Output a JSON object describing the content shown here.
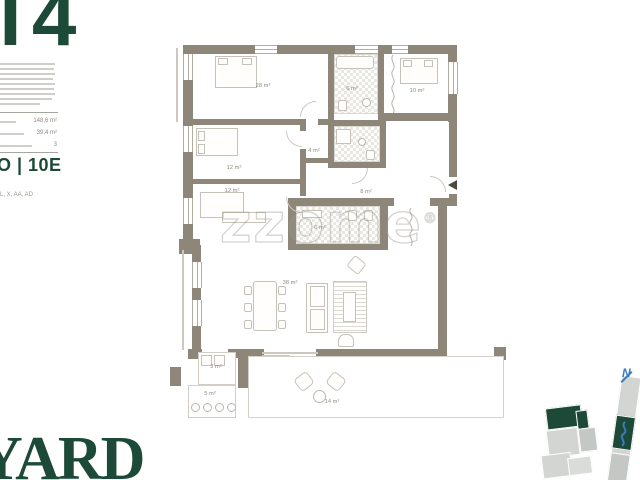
{
  "panel": {
    "unit_type": "T4",
    "unit_code": "O | 10E",
    "finishes": "L, X, AA, AD",
    "areas": {
      "rows": [
        {
          "value": "148,6 m²"
        },
        {
          "value": "39,4 m²"
        },
        {
          "value": "3"
        }
      ]
    }
  },
  "logo": {
    "text": "YARD"
  },
  "watermark": {
    "text": "zzome",
    "reg": "®"
  },
  "plan": {
    "rooms": [
      {
        "name": "bedroom-main",
        "area": "28 m²"
      },
      {
        "name": "bathroom-1",
        "area": "6 m²"
      },
      {
        "name": "bedroom-right",
        "area": "10 m²"
      },
      {
        "name": "bedroom-2",
        "area": "12 m²"
      },
      {
        "name": "closet",
        "area": "4 m²"
      },
      {
        "name": "bedroom-3",
        "area": "12 m²"
      },
      {
        "name": "hall",
        "area": "8 m²"
      },
      {
        "name": "bathroom-2",
        "area": "6 m²"
      },
      {
        "name": "living-room",
        "area": "38 m²"
      },
      {
        "name": "laundry",
        "area": "3 m²"
      },
      {
        "name": "storage",
        "area": "5 m²"
      },
      {
        "name": "terrace",
        "area": "14 m²"
      }
    ]
  },
  "keyplan": {
    "compass_label": "N"
  },
  "colors": {
    "brand_green": "#1d4a38",
    "wall_taupe": "#8d8679",
    "accent_blue": "#3a79bd"
  }
}
